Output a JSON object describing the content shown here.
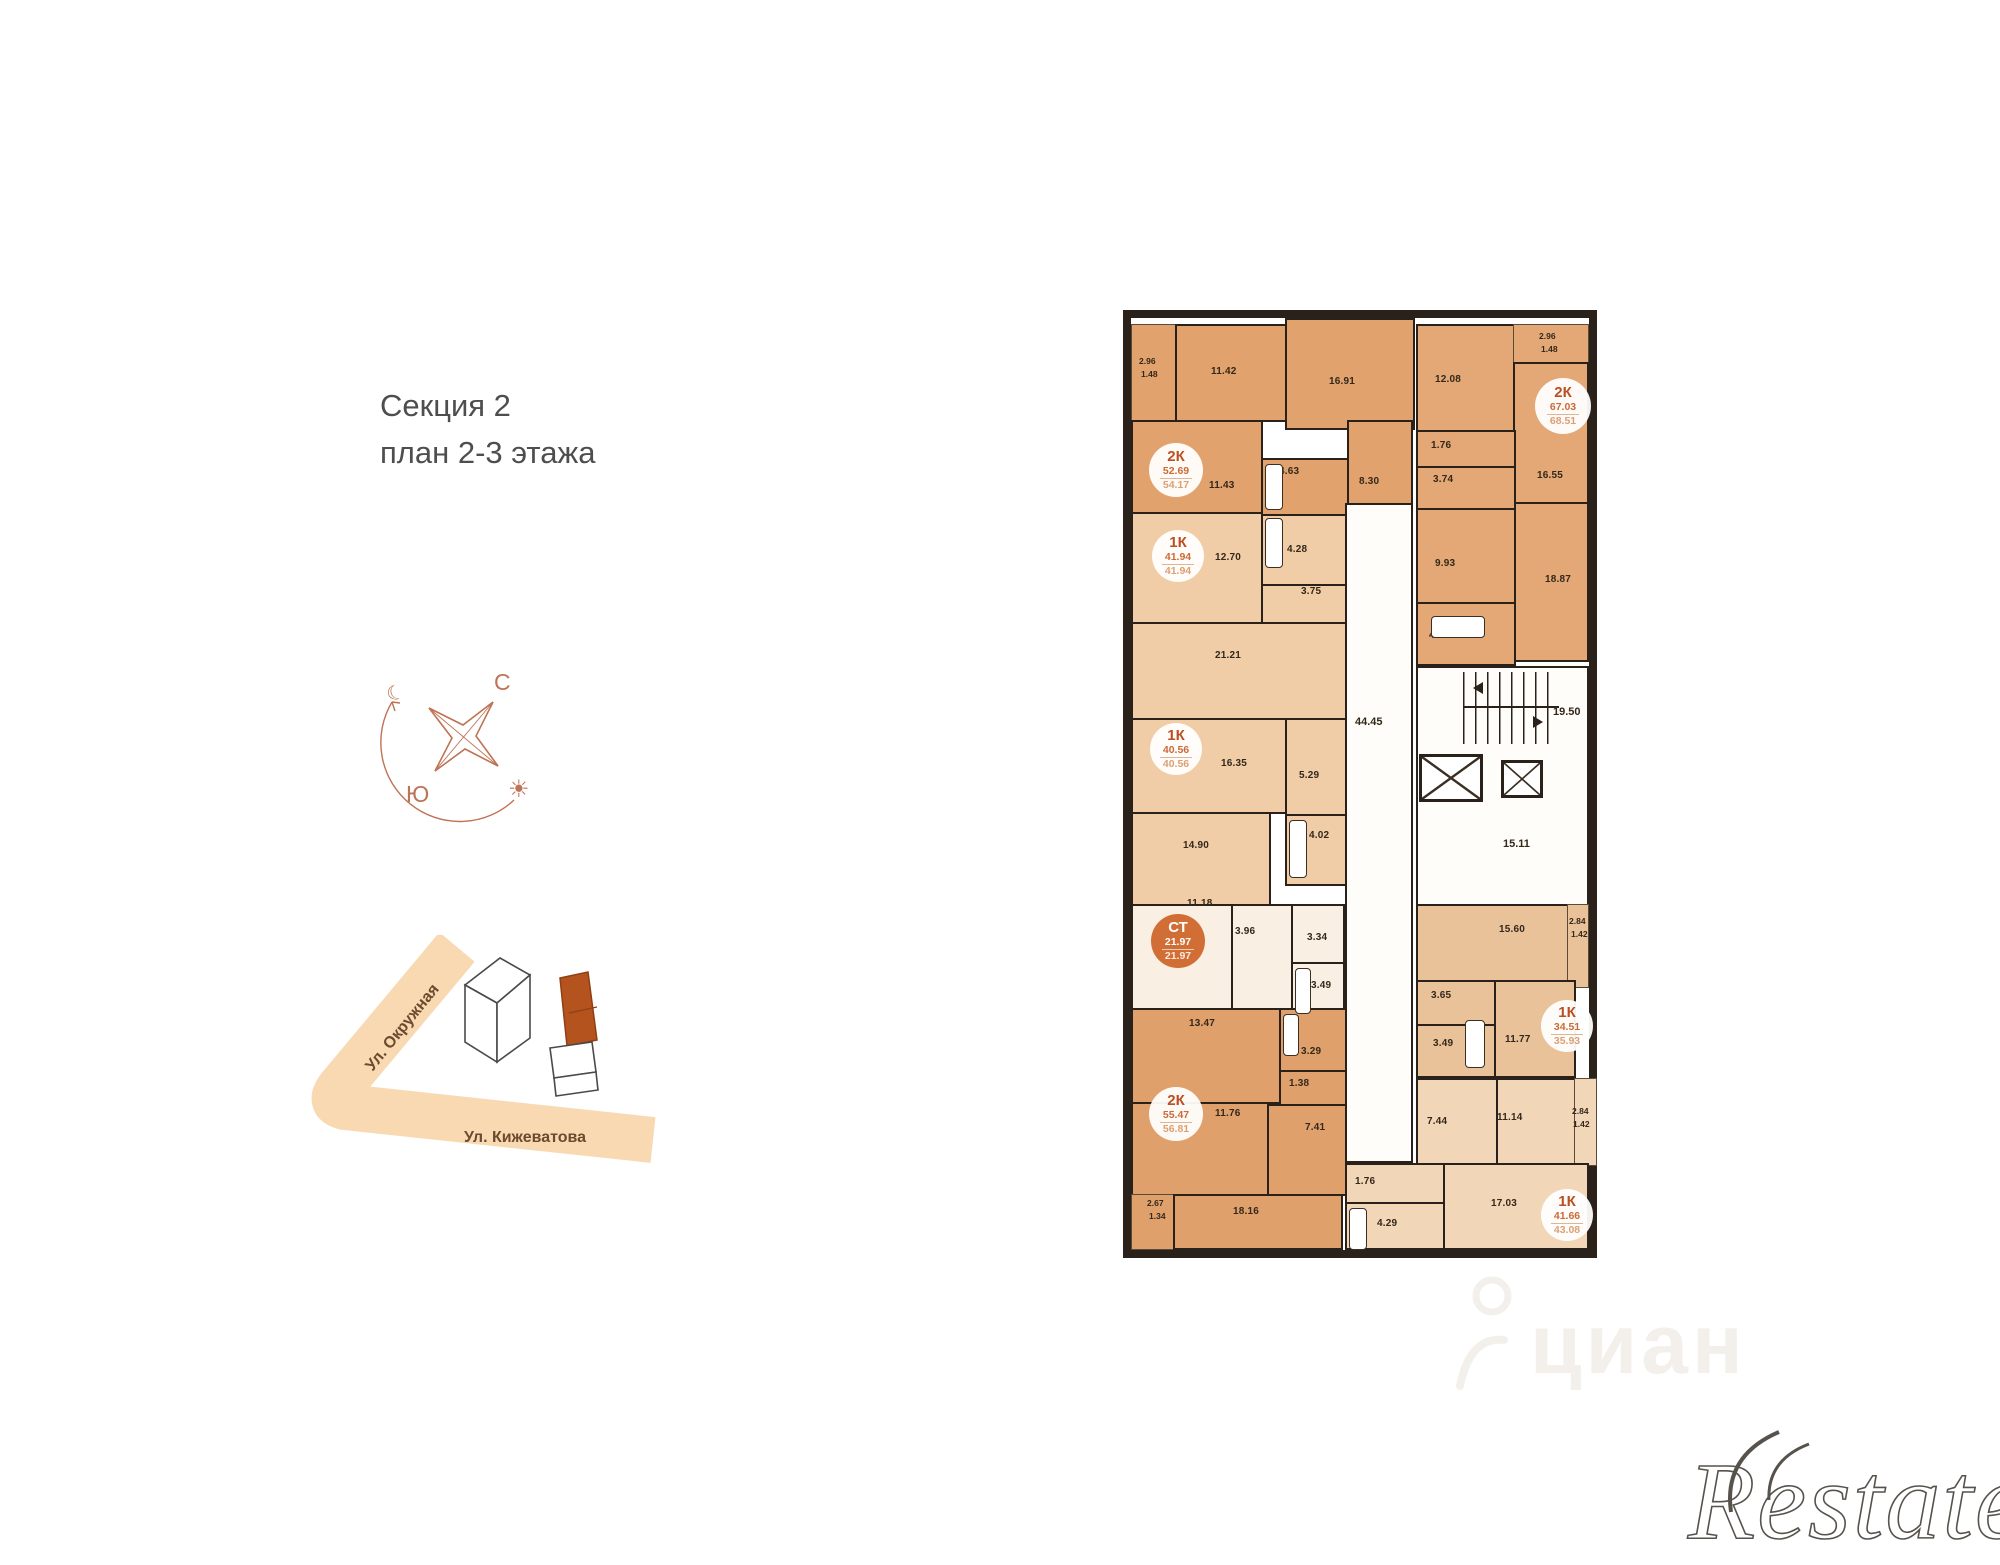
{
  "header": {
    "title_line1": "Секция 2",
    "title_line2": "план 2-3 этажа"
  },
  "compass": {
    "north_label": "С",
    "south_label": "Ю",
    "moon_icon": "☾",
    "sun_icon": "☀",
    "accent_color": "#bf7355"
  },
  "location_map": {
    "street_diagonal": "Ул. Окружная",
    "street_horizontal": "Ул. Кижеватова",
    "road_color": "#f8d9b2",
    "highlight_building_color": "#b4531d"
  },
  "plan": {
    "wall_color": "#29211a",
    "apartments": [
      {
        "type": "2К",
        "area_main": "52.69",
        "area_total": "54.17",
        "rooms": [
          "2.96",
          "1.48",
          "11.42",
          "16.91",
          "11.43",
          "4.63",
          "8.30"
        ]
      },
      {
        "type": "1К",
        "area_main": "41.94",
        "area_total": "41.94",
        "rooms": [
          "12.70",
          "4.28",
          "3.75",
          "21.21"
        ]
      },
      {
        "type": "1К",
        "area_main": "40.56",
        "area_total": "40.56",
        "rooms": [
          "16.35",
          "5.29",
          "14.90",
          "4.02"
        ]
      },
      {
        "type": "СТ",
        "area_main": "21.97",
        "area_total": "21.97",
        "rooms": [
          "11.18",
          "3.96",
          "3.34",
          "3.49"
        ]
      },
      {
        "type": "2К",
        "area_main": "55.47",
        "area_total": "56.81",
        "rooms": [
          "13.47",
          "3.29",
          "1.38",
          "11.76",
          "7.41",
          "2.67",
          "1.34",
          "18.16"
        ]
      },
      {
        "type": "2К",
        "area_main": "67.03",
        "area_total": "68.51",
        "rooms": [
          "2.96",
          "1.48",
          "12.08",
          "1.76",
          "3.74",
          "16.55",
          "9.93",
          "18.87",
          "4.10"
        ]
      },
      {
        "type": "1К",
        "area_main": "34.51",
        "area_total": "35.93",
        "rooms": [
          "15.60",
          "2.84",
          "1.42",
          "3.65",
          "3.49",
          "11.77"
        ]
      },
      {
        "type": "1К",
        "area_main": "41.66",
        "area_total": "43.08",
        "rooms": [
          "7.44",
          "11.14",
          "2.84",
          "1.42",
          "1.76",
          "4.29",
          "17.03"
        ]
      }
    ],
    "common": {
      "corridor": "44.45",
      "stairs": "19.50",
      "hall": "15.11"
    }
  },
  "watermarks": {
    "cian": "циан",
    "restate": "Restate"
  }
}
